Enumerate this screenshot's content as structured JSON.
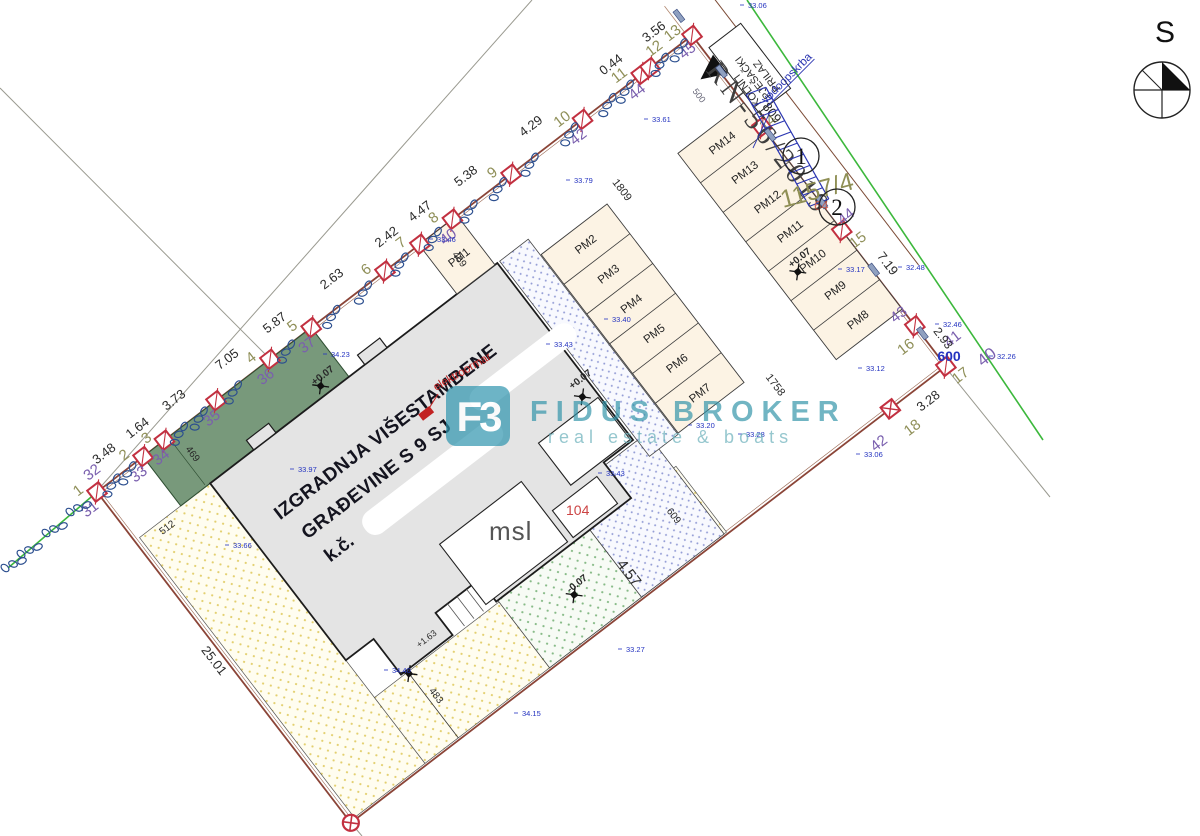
{
  "compass": {
    "label": "S"
  },
  "watermark": {
    "logo": "F3",
    "line1": "FIDUS BROKER",
    "line2": "real estate & boats",
    "color": "#2f93a8"
  },
  "road": {
    "name": "RN-56/2019",
    "access_lines": [
      "KOLNI I",
      "PJEŠAČKI",
      "PRILAZ"
    ],
    "utility": "vodoopskrba",
    "width_label": "500"
  },
  "parcel": {
    "number": "1157/4",
    "old_number": "64",
    "neighbor_number": "104",
    "circled": [
      "1",
      "2"
    ]
  },
  "building": {
    "title": [
      "IZGRADNJA VIŠESTAMBENE",
      "GRAĐEVINE S 9 SJ",
      "k.č."
    ],
    "room": "msl",
    "electro": "elektroormar"
  },
  "parking": {
    "single": "PM1",
    "middle_row": [
      "PM2",
      "PM3",
      "PM4",
      "PM5",
      "PM6",
      "PM7"
    ],
    "right_row": [
      "PM14",
      "PM13",
      "PM12",
      "PM11",
      "PM10",
      "PM9",
      "PM8"
    ]
  },
  "colors": {
    "boundary": "#8b4538",
    "marker": "#c23040",
    "olive": "#8f8f58",
    "purple": "#7a5fae",
    "dim": "#2a2a2a",
    "blue_note": "#2433c0",
    "green_line": "#3cb83c",
    "teal": "#2f93a8",
    "building_fill": "#e4e4e4",
    "stall_fill": "#fcf3e4",
    "green_strip": "#78997b",
    "red_note": "#cc3333"
  },
  "markers": [
    [
      0,
      0,
      "s"
    ],
    [
      58,
      0,
      "s"
    ],
    [
      85,
      0,
      "s"
    ],
    [
      150,
      0,
      "s"
    ],
    [
      218,
      0,
      "s"
    ],
    [
      270,
      0,
      "s"
    ],
    [
      363,
      0,
      "s"
    ],
    [
      407,
      0,
      "s"
    ],
    [
      448,
      0,
      "s"
    ],
    [
      522,
      0,
      "s"
    ],
    [
      612,
      0,
      "s"
    ],
    [
      686,
      0,
      "s"
    ],
    [
      697,
      0,
      "s"
    ],
    [
      750,
      0,
      "s"
    ],
    [
      750,
      115,
      "s"
    ],
    [
      750,
      246,
      "s"
    ],
    [
      750,
      366,
      "s"
    ],
    [
      750,
      417,
      "s"
    ],
    [
      680,
      417,
      "x"
    ],
    [
      0,
      417,
      "c"
    ]
  ],
  "site_texts": [
    {
      "x": 29,
      "y": -22,
      "t": "3.48",
      "f": 13
    },
    {
      "x": 71,
      "y": -22,
      "t": "1.64",
      "f": 13
    },
    {
      "x": 117,
      "y": -22,
      "t": "3.73",
      "f": 13
    },
    {
      "x": 184,
      "y": -22,
      "t": "7.05",
      "f": 13
    },
    {
      "x": 244,
      "y": -22,
      "t": "5.87",
      "f": 13
    },
    {
      "x": 316,
      "y": -22,
      "t": "2.63",
      "f": 13
    },
    {
      "x": 385,
      "y": -22,
      "t": "2.42",
      "f": 13
    },
    {
      "x": 427,
      "y": -22,
      "t": "4.47",
      "f": 13
    },
    {
      "x": 485,
      "y": -22,
      "t": "5.38",
      "f": 13
    },
    {
      "x": 567,
      "y": -22,
      "t": "4.29",
      "f": 13
    },
    {
      "x": 668,
      "y": -22,
      "t": "0.44",
      "f": 13
    },
    {
      "x": 722,
      "y": -22,
      "t": "3.56",
      "f": 13
    },
    {
      "x": -14,
      "y": -8,
      "t": "1",
      "cls": "o"
    },
    {
      "x": 44,
      "y": -8,
      "t": "2",
      "cls": "o"
    },
    {
      "x": 72,
      "y": -8,
      "t": "3",
      "cls": "o"
    },
    {
      "x": 204,
      "y": -8,
      "t": "4",
      "cls": "o"
    },
    {
      "x": 256,
      "y": -8,
      "t": "5",
      "cls": "o"
    },
    {
      "x": 349,
      "y": -8,
      "t": "6",
      "cls": "o"
    },
    {
      "x": 393,
      "y": -8,
      "t": "7",
      "cls": "o"
    },
    {
      "x": 434,
      "y": -8,
      "t": "8",
      "cls": "o"
    },
    {
      "x": 508,
      "y": -8,
      "t": "9",
      "cls": "o"
    },
    {
      "x": 596,
      "y": -8,
      "t": "10",
      "cls": "o"
    },
    {
      "x": 668,
      "y": -8,
      "t": "11",
      "cls": "o"
    },
    {
      "x": 712,
      "y": -8,
      "t": "12",
      "cls": "o"
    },
    {
      "x": 736,
      "y": -9,
      "t": "13",
      "cls": "o"
    },
    {
      "x": 8,
      "y": -14,
      "t": "32",
      "cls": "p"
    },
    {
      "x": -16,
      "y": 14,
      "t": "31",
      "cls": "p"
    },
    {
      "x": 44,
      "y": 16,
      "t": "33",
      "cls": "p"
    },
    {
      "x": 72,
      "y": 16,
      "t": "34",
      "cls": "p"
    },
    {
      "x": 136,
      "y": 16,
      "t": "35",
      "cls": "p"
    },
    {
      "x": 204,
      "y": 16,
      "t": "36",
      "cls": "p"
    },
    {
      "x": 256,
      "y": 16,
      "t": "37",
      "cls": "p"
    },
    {
      "x": 434,
      "y": 16,
      "t": "40",
      "cls": "p"
    },
    {
      "x": 598,
      "y": 16,
      "t": "42",
      "cls": "p"
    },
    {
      "x": 672,
      "y": 16,
      "t": "44",
      "cls": "p"
    },
    {
      "x": 737,
      "y": 14,
      "t": "45",
      "cls": "p"
    },
    {
      "x": 757,
      "y": 120,
      "t": "14",
      "cls": "o"
    },
    {
      "x": 757,
      "y": 268,
      "t": "15",
      "cls": "o"
    },
    {
      "x": 762,
      "y": 242,
      "t": "44",
      "cls": "p"
    },
    {
      "x": 730,
      "y": 382,
      "t": "16",
      "cls": "o"
    },
    {
      "x": 744,
      "y": 352,
      "t": "43",
      "cls": "p"
    },
    {
      "x": 756,
      "y": 438,
      "t": "17",
      "cls": "o",
      "f": 15
    },
    {
      "x": 788,
      "y": 440,
      "t": "40",
      "cls": "p",
      "f": 17
    },
    {
      "x": 772,
      "y": 404,
      "t": "41",
      "cls": "p",
      "f": 15
    },
    {
      "x": 686,
      "y": 450,
      "t": "18",
      "cls": "o"
    },
    {
      "x": 650,
      "y": 442,
      "t": "42",
      "cls": "p"
    },
    {
      "x": 715,
      "y": 438,
      "t": "3.28",
      "f": 13
    },
    {
      "x": 762,
      "y": 110,
      "r": 90,
      "t": "809",
      "f": 13
    },
    {
      "x": 762,
      "y": 300,
      "r": 90,
      "t": "7.19",
      "f": 13
    },
    {
      "x": 761,
      "y": 393,
      "r": 90,
      "t": "2.93",
      "f": 12
    },
    {
      "x": -14,
      "y": 205,
      "r": 90,
      "t": "25.01",
      "f": 13
    },
    {
      "x": 597,
      "y": 80,
      "r": 90,
      "t": "1809",
      "f": 11
    },
    {
      "x": 600,
      "y": 328,
      "r": 90,
      "t": "1758",
      "f": 11
    },
    {
      "x": 426,
      "y": 36,
      "r": 90,
      "t": "469",
      "f": 10
    },
    {
      "x": 96,
      "y": 28,
      "r": 90,
      "t": "469",
      "f": 10
    },
    {
      "x": 34,
      "y": 74,
      "t": "512",
      "f": 10
    },
    {
      "x": 142,
      "y": 368,
      "r": 90,
      "t": "483",
      "f": 10
    },
    {
      "x": 440,
      "y": 370,
      "r": 90,
      "t": "609",
      "f": 10
    },
    {
      "x": 368,
      "y": 388,
      "r": 90,
      "t": "4.57",
      "f": 15
    },
    {
      "x": 716,
      "y": 52,
      "r": 90,
      "t": "500",
      "f": 9,
      "c": "#667"
    },
    {
      "x": 739,
      "y": 36,
      "r": 90,
      "t": "RN-56/2019",
      "f": 29,
      "ff": "serif",
      "ls": 4,
      "c": "#3f3f3f",
      "a": "start"
    },
    {
      "x": 764,
      "y": 96,
      "r": -90,
      "t": "KOLNI I",
      "f": 10.5,
      "a": "start",
      "bind": "road.access_lines.0"
    },
    {
      "x": 776,
      "y": 96,
      "r": -90,
      "t": "PJEŠAČKI",
      "f": 10.5,
      "a": "start",
      "bind": "road.access_lines.1"
    },
    {
      "x": 788,
      "y": 96,
      "r": -90,
      "t": "PRILAZ",
      "f": 10.5,
      "a": "start",
      "bind": "road.access_lines.2"
    },
    {
      "x": 128,
      "y": 134,
      "t": "IZGRADNJA VIŠESTAMBENE",
      "f": 19,
      "w": "bold",
      "c": "#14141f",
      "a": "start",
      "ls": 0.5
    },
    {
      "x": 138,
      "y": 166,
      "t": "GRAĐEVINE S 9 SJ",
      "f": 19,
      "w": "bold",
      "c": "#14141f",
      "a": "start",
      "ls": 0.5
    },
    {
      "x": 142,
      "y": 198,
      "t": "k.č.",
      "f": 19,
      "w": "bold",
      "c": "#14141f",
      "a": "start"
    },
    {
      "x": 250,
      "y": 48,
      "t": "+0.07",
      "f": 10,
      "w": "bold"
    },
    {
      "x": 452,
      "y": 208,
      "t": "+0.07",
      "f": 10,
      "w": "bold"
    },
    {
      "x": 700,
      "y": 245,
      "t": "+0.07",
      "f": 10,
      "w": "bold"
    },
    {
      "x": 325,
      "y": 368,
      "t": "-0.07",
      "f": 10,
      "w": "bold"
    },
    {
      "x": 172,
      "y": 320,
      "t": "+1.63",
      "f": 9
    }
  ],
  "page_texts": [
    {
      "x": 949,
      "y": 361,
      "t": "600",
      "f": 14,
      "c": "#2433c0",
      "w": "bold"
    }
  ],
  "elevations": [
    [
      748,
      8,
      "33.06"
    ],
    [
      652,
      122,
      "33.61"
    ],
    [
      574,
      183,
      "33.79"
    ],
    [
      906,
      270,
      "32.48"
    ],
    [
      943,
      327,
      "32.46"
    ],
    [
      997,
      359,
      "32.26"
    ],
    [
      864,
      457,
      "33.06"
    ],
    [
      554,
      347,
      "33.43"
    ],
    [
      437,
      242,
      "33.46"
    ],
    [
      331,
      357,
      "34.23"
    ],
    [
      233,
      548,
      "33.66"
    ],
    [
      392,
      673,
      "34.40"
    ],
    [
      522,
      716,
      "34.15"
    ],
    [
      626,
      652,
      "33.27"
    ],
    [
      746,
      437,
      "33.28"
    ],
    [
      696,
      428,
      "33.20"
    ],
    [
      606,
      476,
      "33.43"
    ],
    [
      866,
      371,
      "33.12"
    ],
    [
      846,
      272,
      "33.17"
    ],
    [
      612,
      322,
      "33.40"
    ],
    [
      298,
      472,
      "33.97"
    ]
  ],
  "bushes_site_u": [
    15,
    35,
    100,
    125,
    168,
    235,
    292,
    332,
    378,
    420,
    465,
    502,
    542,
    592,
    640,
    662,
    706,
    730
  ],
  "bushes_page": [
    [
      78,
      508
    ],
    [
      54,
      529
    ],
    [
      29,
      550
    ],
    [
      13,
      564
    ]
  ],
  "gullies_v": [
    -30,
    40,
    120,
    205,
    290,
    370
  ],
  "stall_rows": {
    "middle": {
      "x": 497,
      "y": 82,
      "w": 83,
      "h": 225
    },
    "right": {
      "x": 667,
      "y": 85,
      "w": 83,
      "h": 260
    },
    "single": {
      "x": 406,
      "y": 0,
      "w": 48,
      "h": 62
    }
  },
  "symbols": [
    [
      242,
      52
    ],
    [
      443,
      220
    ],
    [
      690,
      252
    ],
    [
      316,
      372
    ],
    [
      137,
      334
    ]
  ]
}
